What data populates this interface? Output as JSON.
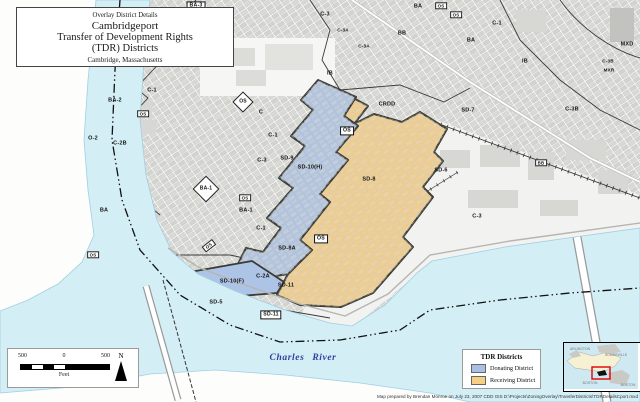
{
  "title_box": {
    "line1": "Overlay District Details",
    "line2": "Cambridgeport",
    "line3": "Transfer of Development Rights",
    "line4": "(TDR) Districts",
    "line5": "Cambridge, Massachusetts"
  },
  "legend": {
    "title": "TDR Districts",
    "items": [
      {
        "label": "Donating District",
        "color": "#a9c0e4"
      },
      {
        "label": "Receiving District",
        "color": "#f6cf87"
      }
    ]
  },
  "scale_bar": {
    "left": "500",
    "mid": "0",
    "right": "500",
    "unit": "Feet",
    "north": "N"
  },
  "attribution": "Map prepared by Brendan Monroe on July 23, 2007    CDD GIS    D:\\Projects\\ZoningOverlay\\TransferDistricts\\TDRDetailsCport.mxd",
  "inset": {
    "labels": [
      {
        "t": "ARLINGTON",
        "x": 16,
        "y": 6
      },
      {
        "t": "SOMERVILLE",
        "x": 52,
        "y": 12
      },
      {
        "t": "BOSTON",
        "x": 26,
        "y": 40
      },
      {
        "t": "BOSTON",
        "x": 64,
        "y": 42
      }
    ]
  },
  "colors": {
    "water": "#d4eef6",
    "donating": "#aec4e6",
    "receiving": "#f6cf87",
    "land": "#f5f5f3"
  },
  "map_labels": [
    {
      "t": "BA-3",
      "x": 196,
      "y": 6,
      "cls": "box"
    },
    {
      "t": "C-1",
      "x": 193,
      "y": 16,
      "cls": ""
    },
    {
      "t": "C-3",
      "x": 325,
      "y": 15,
      "cls": ""
    },
    {
      "t": "C-3A",
      "x": 343,
      "y": 31,
      "cls": "sm"
    },
    {
      "t": "C-3A",
      "x": 364,
      "y": 47,
      "cls": "sm"
    },
    {
      "t": "BA",
      "x": 418,
      "y": 7,
      "cls": ""
    },
    {
      "t": "OS",
      "x": 441,
      "y": 6,
      "cls": "boxs"
    },
    {
      "t": "OS",
      "x": 456,
      "y": 15,
      "cls": "boxs"
    },
    {
      "t": "C-1",
      "x": 497,
      "y": 24,
      "cls": ""
    },
    {
      "t": "BA",
      "x": 471,
      "y": 41,
      "cls": ""
    },
    {
      "t": "BB",
      "x": 402,
      "y": 34,
      "cls": ""
    },
    {
      "t": "MXD",
      "x": 627,
      "y": 45,
      "cls": ""
    },
    {
      "t": "C-3B",
      "x": 608,
      "y": 62,
      "cls": "sm"
    },
    {
      "t": "MXR",
      "x": 609,
      "y": 71,
      "cls": "sm"
    },
    {
      "t": "C-3B",
      "x": 572,
      "y": 110,
      "cls": ""
    },
    {
      "t": "IB",
      "x": 525,
      "y": 62,
      "cls": ""
    },
    {
      "t": "IB",
      "x": 330,
      "y": 74,
      "cls": ""
    },
    {
      "t": "CRDD",
      "x": 387,
      "y": 105,
      "cls": ""
    },
    {
      "t": "SD-7",
      "x": 468,
      "y": 111,
      "cls": ""
    },
    {
      "t": "BB",
      "x": 541,
      "y": 163,
      "cls": "boxs"
    },
    {
      "t": "SD-6",
      "x": 441,
      "y": 171,
      "cls": ""
    },
    {
      "t": "C-3",
      "x": 477,
      "y": 217,
      "cls": ""
    },
    {
      "t": "C-1",
      "x": 152,
      "y": 91,
      "cls": ""
    },
    {
      "t": "BA-2",
      "x": 115,
      "y": 101,
      "cls": ""
    },
    {
      "t": "OS",
      "x": 143,
      "y": 114,
      "cls": "boxs"
    },
    {
      "t": "O-2",
      "x": 93,
      "y": 139,
      "cls": ""
    },
    {
      "t": "C-2B",
      "x": 120,
      "y": 144,
      "cls": ""
    },
    {
      "t": "C",
      "x": 261,
      "y": 113,
      "cls": ""
    },
    {
      "t": "OS",
      "x": 243,
      "y": 102,
      "cls": "dia"
    },
    {
      "t": "C-1",
      "x": 273,
      "y": 136,
      "cls": ""
    },
    {
      "t": "C-3",
      "x": 262,
      "y": 161,
      "cls": ""
    },
    {
      "t": "SD-9",
      "x": 287,
      "y": 159,
      "cls": ""
    },
    {
      "t": "SD-10(H)",
      "x": 310,
      "y": 168,
      "cls": ""
    },
    {
      "t": "OS",
      "x": 347,
      "y": 131,
      "cls": "box"
    },
    {
      "t": "SD-8",
      "x": 369,
      "y": 180,
      "cls": ""
    },
    {
      "t": "BA-1",
      "x": 206,
      "y": 189,
      "cls": "dia"
    },
    {
      "t": "OS",
      "x": 245,
      "y": 198,
      "cls": "boxs"
    },
    {
      "t": "BA-1",
      "x": 246,
      "y": 211,
      "cls": ""
    },
    {
      "t": "BA",
      "x": 104,
      "y": 211,
      "cls": ""
    },
    {
      "t": "OS",
      "x": 93,
      "y": 255,
      "cls": "boxs"
    },
    {
      "t": "OS",
      "x": 209,
      "y": 246,
      "cls": "rot"
    },
    {
      "t": "C-1",
      "x": 261,
      "y": 229,
      "cls": ""
    },
    {
      "t": "SD-8A",
      "x": 287,
      "y": 249,
      "cls": ""
    },
    {
      "t": "OS",
      "x": 321,
      "y": 239,
      "cls": "box"
    },
    {
      "t": "C-2A",
      "x": 263,
      "y": 277,
      "cls": ""
    },
    {
      "t": "SD-10(F)",
      "x": 232,
      "y": 282,
      "cls": ""
    },
    {
      "t": "SD-11",
      "x": 286,
      "y": 286,
      "cls": ""
    },
    {
      "t": "SD-5",
      "x": 216,
      "y": 303,
      "cls": ""
    },
    {
      "t": "SD-11",
      "x": 271,
      "y": 315,
      "cls": "box"
    },
    {
      "t": "Charles  River",
      "x": 303,
      "y": 358,
      "cls": "river"
    }
  ]
}
